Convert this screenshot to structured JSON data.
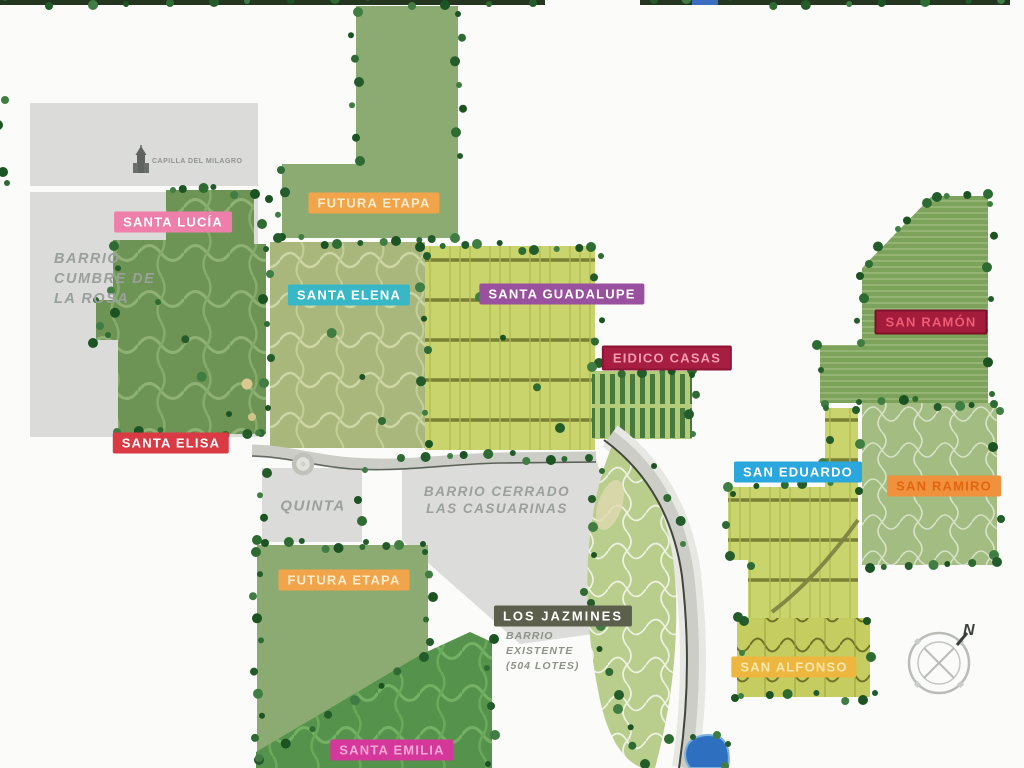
{
  "labels": {
    "santa_lucia": {
      "text": "SANTA LUCÍA",
      "bg": "#ee7fab",
      "fg": "#ffffff"
    },
    "futura_etapa_1": {
      "text": "FUTURA ETAPA",
      "bg": "#f2a44a",
      "fg": "#fdeccb"
    },
    "santa_elena": {
      "text": "SANTA ELENA",
      "bg": "#38b8c6",
      "fg": "#ffffff"
    },
    "santa_guadalupe": {
      "text": "SANTA GUADALUPE",
      "bg": "#99519f",
      "fg": "#ffffff"
    },
    "eidico_casas": {
      "text": "EIDICO CASAS",
      "bg": "#a81e42",
      "fg": "#f29cb2",
      "border": "#8c1434"
    },
    "san_ramon": {
      "text": "SAN RAMÓN",
      "bg": "#a31c3c",
      "fg": "#ef5a75",
      "border": "#7c1129"
    },
    "santa_elisa": {
      "text": "SANTA ELISA",
      "bg": "#d93a43",
      "fg": "#ffffff"
    },
    "san_eduardo": {
      "text": "SAN EDUARDO",
      "bg": "#2aa7dd",
      "fg": "#ffffff"
    },
    "san_ramiro": {
      "text": "SAN RAMIRO",
      "bg": "#f0913e",
      "fg": "#e2660f"
    },
    "futura_etapa_2": {
      "text": "FUTURA ETAPA",
      "bg": "#f2a44a",
      "fg": "#fdeccb"
    },
    "los_jazmines": {
      "text": "LOS JAZMINES",
      "bg": "#5c5f4b",
      "fg": "#ffffff"
    },
    "san_alfonso": {
      "text": "SAN ALFONSO",
      "bg": "#edb73f",
      "fg": "#f8e7ac"
    },
    "santa_emilia": {
      "text": "SANTA EMILIA",
      "bg": "#d6379b",
      "fg": "#f2a8d4"
    }
  },
  "notes": {
    "cumbre_de_la_rosa": "BARRIO\nCUMBRE DE\nLA ROSA",
    "quinta": "QUINTA",
    "las_casuarinas": "BARRIO CERRADO\nLAS CASUARINAS",
    "los_jazmines_note": "BARRIO\nEXISTENTE\n(504 LOTES)",
    "capilla": "CAPILLA DEL MILAGRO"
  },
  "compass": {
    "north_label": "N"
  },
  "colors": {
    "background": "#fbfbf9",
    "gray_area": "#dbdbda",
    "sage_area": "#8cab72",
    "dark_barrio_green": "#6d9454",
    "lots_yellow_green": "#cad46d",
    "road": "#cbcdc6",
    "road_edge": "#40463c",
    "lake": "#2f6fbf",
    "tree_green": "#2e6b33",
    "gray_text": "#9aa09c"
  }
}
